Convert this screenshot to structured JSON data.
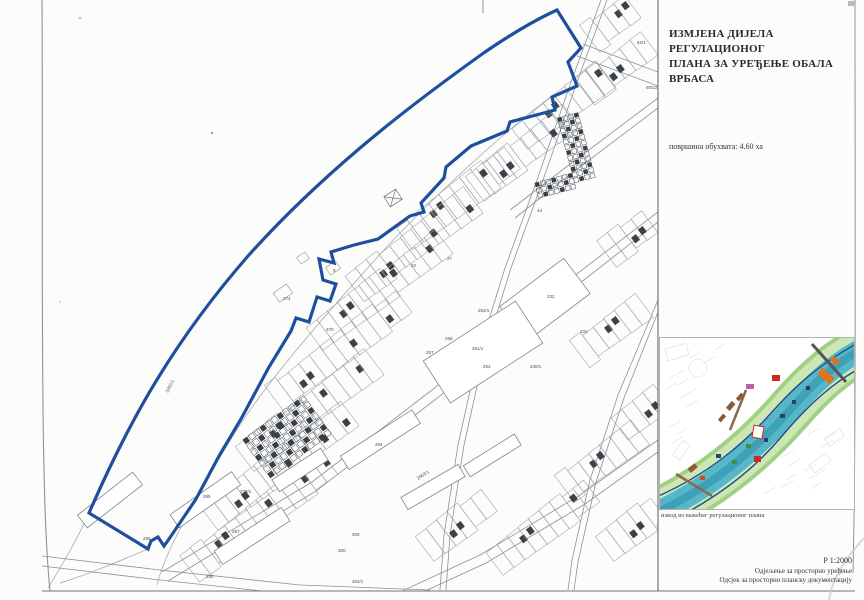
{
  "panel": {
    "title_line1": "ИЗМЈЕНА ДИЈЕЛА РЕГУЛАЦИОНОГ",
    "title_line2": "ПЛАНА ЗА УРЕЂЕЊЕ ОБАЛА ВРБАСА",
    "area_label": "површина обухвата: 4.60 ха",
    "inset_caption": "извод из важећег регулационог плана",
    "scale": "Р 1:2000",
    "dept_line1": "Одјељење за просторно уређење",
    "dept_line2": "Одсјек за просторно планску документацију"
  },
  "map": {
    "boundary_color": "#1e4f9e",
    "labels": [
      {
        "text": "62/1",
        "x": 637,
        "y": 44
      },
      {
        "text": "60/22",
        "x": 646,
        "y": 89
      },
      {
        "text": "62",
        "x": 597,
        "y": 73
      },
      {
        "text": "44",
        "x": 537,
        "y": 212
      },
      {
        "text": "27",
        "x": 447,
        "y": 260
      },
      {
        "text": "22",
        "x": 411,
        "y": 267
      },
      {
        "text": "9",
        "x": 333,
        "y": 272
      },
      {
        "text": "274",
        "x": 283,
        "y": 300
      },
      {
        "text": "270",
        "x": 326,
        "y": 331
      },
      {
        "text": "232",
        "x": 547,
        "y": 298
      },
      {
        "text": "233",
        "x": 580,
        "y": 333
      },
      {
        "text": "254/1",
        "x": 478,
        "y": 312
      },
      {
        "text": "251/1",
        "x": 472,
        "y": 350
      },
      {
        "text": "252",
        "x": 483,
        "y": 368
      },
      {
        "text": "240/1",
        "x": 530,
        "y": 368
      },
      {
        "text": "258",
        "x": 445,
        "y": 340
      },
      {
        "text": "257",
        "x": 426,
        "y": 354
      },
      {
        "text": "3202/1",
        "x": 168,
        "y": 393,
        "rot": -62
      },
      {
        "text": "2953/1",
        "x": 418,
        "y": 480,
        "rot": -33
      },
      {
        "text": "278/1",
        "x": 240,
        "y": 493
      },
      {
        "text": "295",
        "x": 203,
        "y": 498
      },
      {
        "text": "294",
        "x": 375,
        "y": 446
      },
      {
        "text": "297",
        "x": 232,
        "y": 533
      },
      {
        "text": "296",
        "x": 143,
        "y": 540
      },
      {
        "text": "290",
        "x": 206,
        "y": 578
      },
      {
        "text": "300",
        "x": 338,
        "y": 552
      },
      {
        "text": "309",
        "x": 352,
        "y": 536
      },
      {
        "text": "302/1",
        "x": 352,
        "y": 583
      }
    ]
  },
  "inset": {
    "river_color": "#55b7c7",
    "bank_color": "#cde7b4",
    "boundary_color": "#1c4b8f"
  }
}
